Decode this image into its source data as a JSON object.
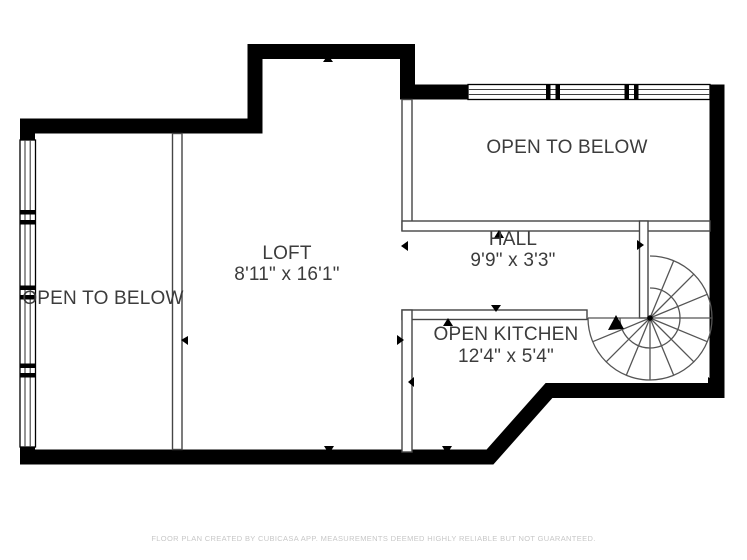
{
  "colors": {
    "background": "#ffffff",
    "thick_wall": "#000000",
    "thin_wall_stroke": "#454545",
    "stair_stroke": "#555555",
    "label_text": "#3c3c3c",
    "footer_text": "#c7c7c7"
  },
  "rooms": {
    "open_to_below_left": {
      "label": "OPEN TO BELOW"
    },
    "loft": {
      "label": "LOFT",
      "dimensions": "8'11\" x 16'1\""
    },
    "open_to_below_right": {
      "label": "OPEN TO BELOW"
    },
    "hall": {
      "label": "HALL",
      "dimensions": "9'9\" x 3'3\""
    },
    "open_kitchen": {
      "label": "OPEN KITCHEN",
      "dimensions": "12'4\" x 5'4\""
    }
  },
  "icons": {
    "spiral_staircase": "spiral-staircase-icon",
    "direction_marker": "triangle-marker-icon",
    "window": "window-symbol"
  },
  "footer": {
    "disclaimer": "FLOOR PLAN CREATED BY CUBICASA APP. MEASUREMENTS DEEMED HIGHLY RELIABLE BUT NOT GUARANTEED."
  }
}
